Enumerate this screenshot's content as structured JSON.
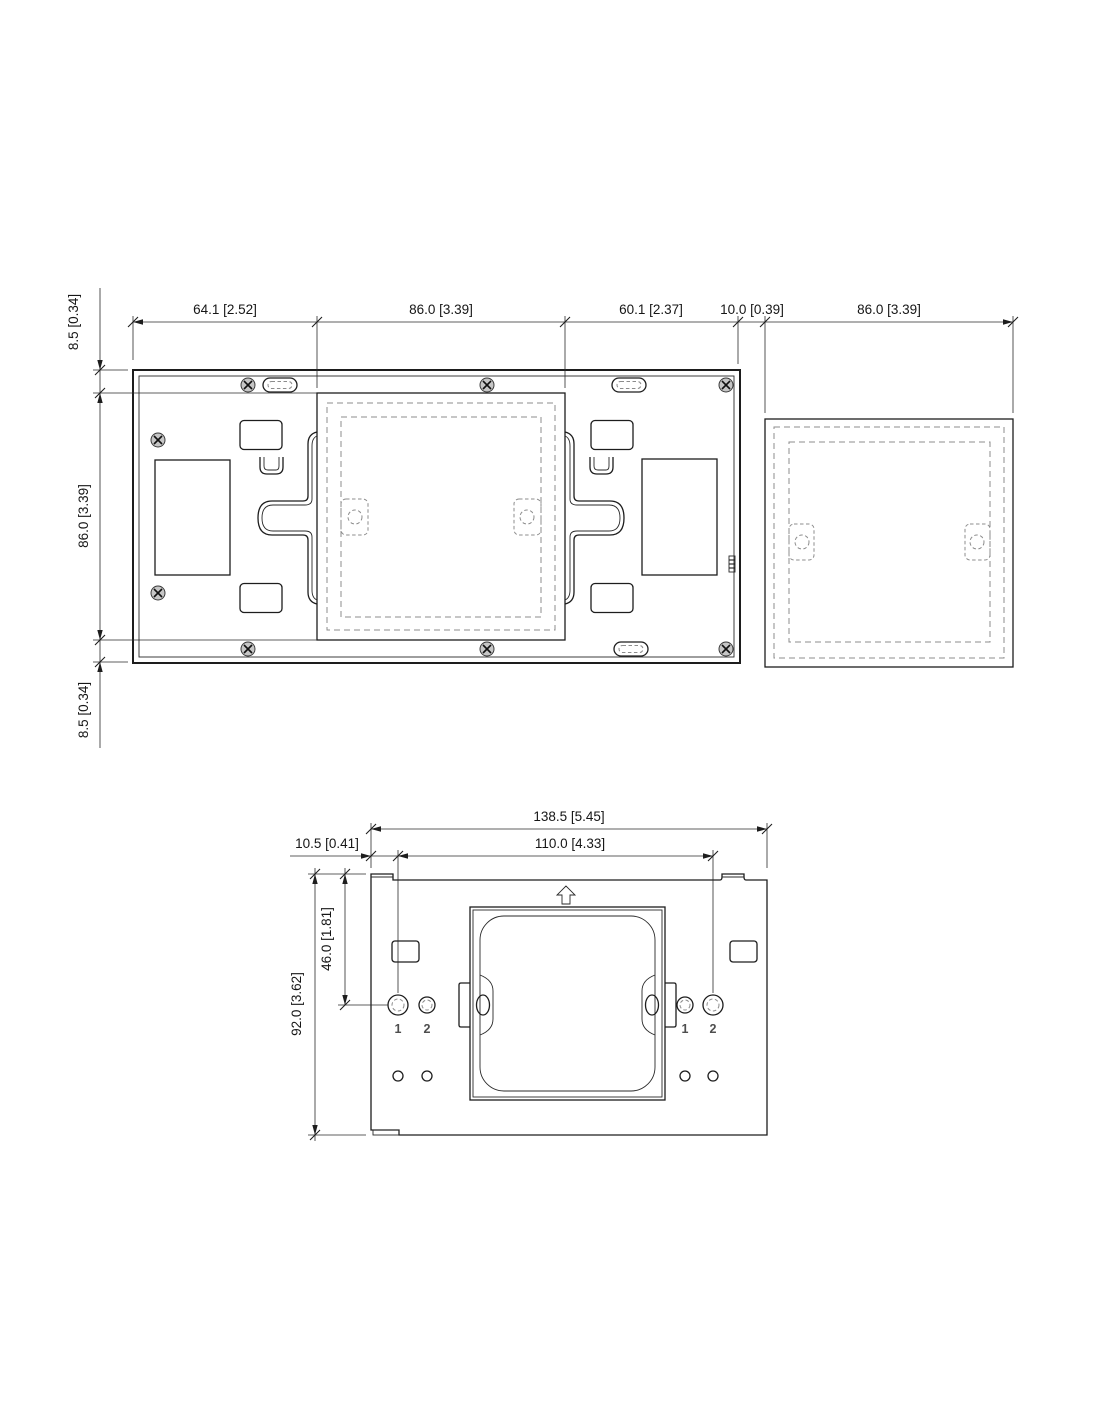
{
  "diagram": {
    "type": "technical-dimension-drawing",
    "background": "#ffffff",
    "line_color": "#1d1d1d",
    "dashed_color": "#8c8c8c",
    "screw_fill": "#c6c6c6",
    "plate_front_view": {
      "dims_top": [
        {
          "label": "64.1 [2.52]",
          "mm": 64.1,
          "inch": 2.52
        },
        {
          "label": "86.0 [3.39]",
          "mm": 86.0,
          "inch": 3.39
        },
        {
          "label": "60.1 [2.37]",
          "mm": 60.1,
          "inch": 2.37
        },
        {
          "label": "10.0 [0.39]",
          "mm": 10.0,
          "inch": 0.39
        },
        {
          "label": "86.0 [3.39]",
          "mm": 86.0,
          "inch": 3.39
        }
      ],
      "dims_left": [
        {
          "label": "8.5 [0.34]",
          "mm": 8.5,
          "inch": 0.34
        },
        {
          "label": "86.0 [3.39]",
          "mm": 86.0,
          "inch": 3.39
        },
        {
          "label": "8.5 [0.34]",
          "mm": 8.5,
          "inch": 0.34
        }
      ]
    },
    "bracket_view": {
      "dims": {
        "total_width": {
          "label": "138.5 [5.45]",
          "mm": 138.5,
          "inch": 5.45
        },
        "hole_span": {
          "label": "110.0 [4.33]",
          "mm": 110.0,
          "inch": 4.33
        },
        "edge_offset": {
          "label": "10.5 [0.41]",
          "mm": 10.5,
          "inch": 0.41
        },
        "total_height": {
          "label": "92.0 [3.62]",
          "mm": 92.0,
          "inch": 3.62
        },
        "hole_drop": {
          "label": "46.0 [1.81]",
          "mm": 46.0,
          "inch": 1.81
        }
      },
      "hole_labels": [
        "1",
        "2",
        "1",
        "2"
      ],
      "orientation_icon": "up-arrow"
    }
  }
}
